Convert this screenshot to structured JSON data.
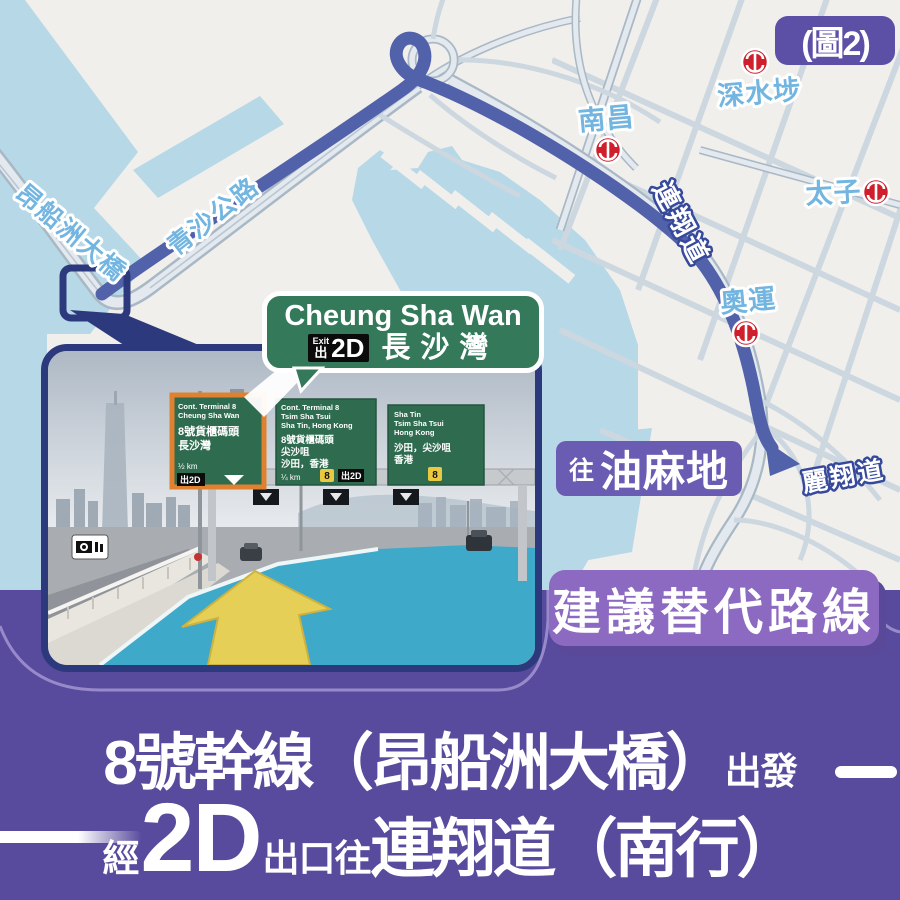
{
  "figure_label": "(圖2)",
  "colors": {
    "band_purple": "#584a9c",
    "alt_box_purple": "#8d6ac2",
    "badge_purple": "#5b50a6",
    "yau_box_purple": "#6a5cb2",
    "route_blue": "#5161aa",
    "frame_navy": "#2c3a7d",
    "sign_green": "#33795a",
    "mtr_red": "#cf1f2c",
    "label_blue": "#72b5e0",
    "water_blue": "#b7d8e7",
    "cyan_lane": "#3fa9c9",
    "arrow_yellow": "#e5cf57"
  },
  "map": {
    "labels": {
      "stonecutters": "昂船洲大橋",
      "tsing_sha": "青沙公路",
      "lin_cheung": "連翔道",
      "lai_cheung": "麗翔道"
    },
    "stations": [
      {
        "name": "深水埗"
      },
      {
        "name": "南昌"
      },
      {
        "name": "太子"
      },
      {
        "name": "奧運"
      }
    ],
    "to_yau": {
      "prefix": "往",
      "name": "油麻地"
    }
  },
  "callout": {
    "line1": "Cheung Sha Wan",
    "exit_word": "Exit",
    "exit_cjk": "出",
    "exit_code": "2D",
    "cjk": "長沙灣"
  },
  "photo": {
    "signA": {
      "e1": "Cont. Terminal 8",
      "e2": "Cheung Sha Wan",
      "c1": "8號貨櫃碼頭",
      "c2": "長沙灣",
      "d": "½ km",
      "exit": "出2D"
    },
    "signB": {
      "e1": "Cont. Terminal 8",
      "e2": "Tsim Sha Tsui",
      "e3": "Sha Tin, Hong Kong",
      "c1": "8號貨櫃碼頭",
      "c2": "尖沙咀",
      "c3": "沙田，香港",
      "d": "¼ km",
      "route": "8",
      "exit": "出2D"
    },
    "signC": {
      "e1": "Sha Tin",
      "e2": "Tsim Sha Tsui",
      "e3": "Hong Kong",
      "c1": "沙田，尖沙咀",
      "c2": "香港",
      "route": "8"
    }
  },
  "alt_route_label": "建議替代路線",
  "headline": {
    "l1_main": "8號幹線（昂船洲大橋）",
    "l1_small": "出發",
    "l2_pre": "經",
    "l2_big": "2D",
    "l2_mid": "出口往",
    "l2_main": "連翔道（南行）"
  }
}
